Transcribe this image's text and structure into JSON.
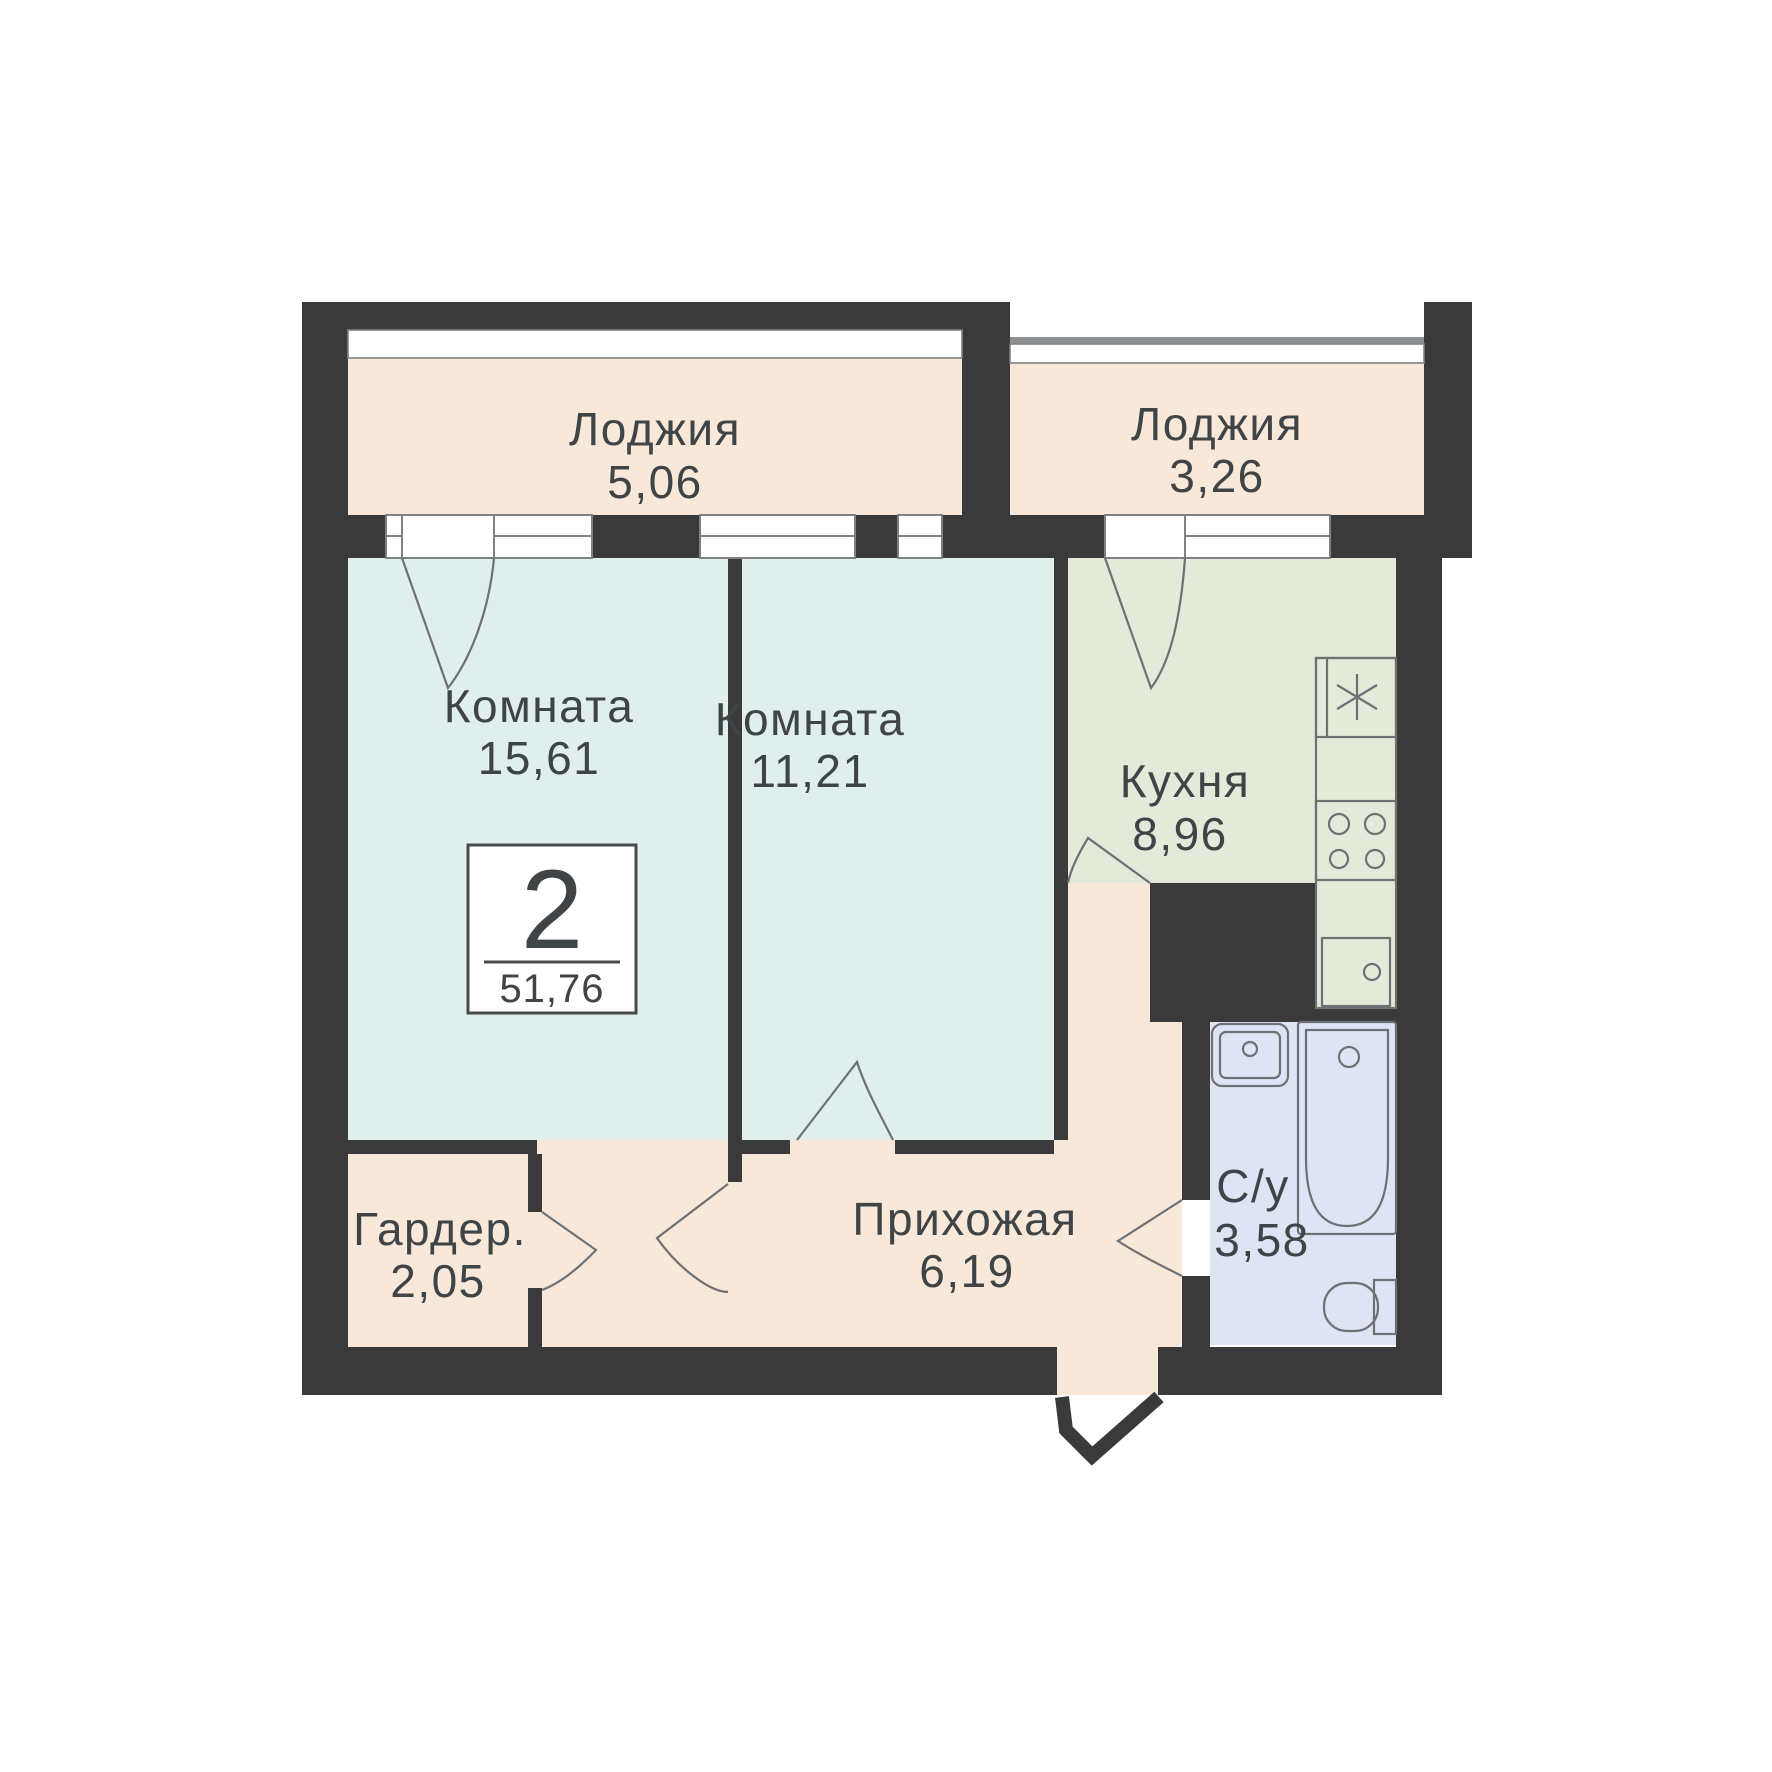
{
  "colors": {
    "wall": "#3a3a3a",
    "loggia": "#f8e8da",
    "room": "#e1efec",
    "kitchen": "#e3ead9",
    "bath": "#dfe4f4"
  },
  "rooms": {
    "loggia1": {
      "name": "Лоджия",
      "area": "5,06"
    },
    "loggia2": {
      "name": "Лоджия",
      "area": "3,26"
    },
    "room1": {
      "name": "Комната",
      "area": "15,61"
    },
    "room2": {
      "name": "Комната",
      "area": "11,21"
    },
    "kitchen": {
      "name": "Кухня",
      "area": "8,96"
    },
    "wardrobe": {
      "name": "Гардер.",
      "area": "2,05"
    },
    "hall": {
      "name": "Прихожая",
      "area": "6,19"
    },
    "bath": {
      "name": "С/у",
      "area": "3,58"
    }
  },
  "summary": {
    "rooms_count": "2",
    "total_area": "51,76"
  }
}
